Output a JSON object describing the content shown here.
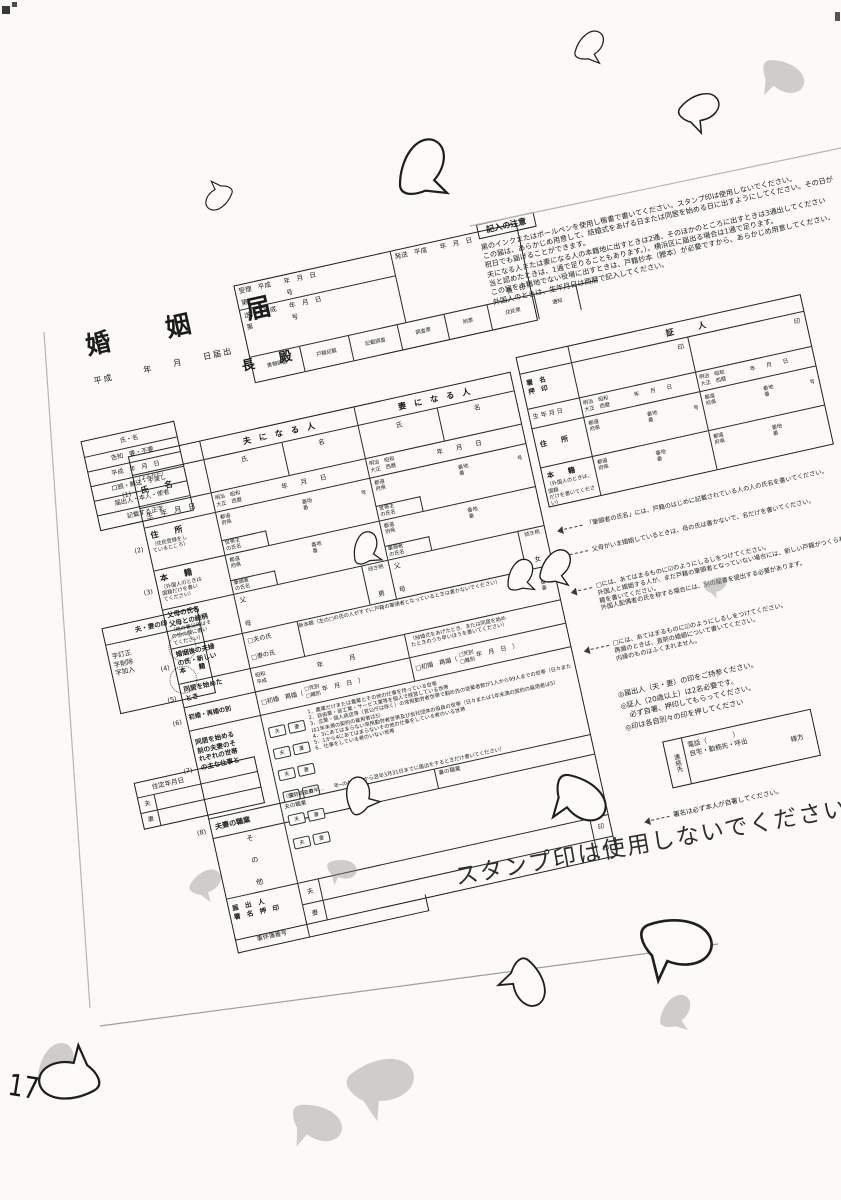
{
  "title_block": {
    "title": "婚　姻　届",
    "date_line": "平成　　　年　　月　　日届出",
    "addressee": "長　殿"
  },
  "receipt_box": {
    "juri": "受理　平成　　年　月　日",
    "juri_no": "第　　　　　　号",
    "hasso": "発送　平成　　年　月　日",
    "mayor_seal": "長　印",
    "sofu": "送付　平成　　年　月　日",
    "sofu_no": "第　　　　　　号",
    "cells": [
      "書類調査",
      "戸籍記載",
      "記載調査",
      "調査票",
      "附票",
      "住民票",
      "通知"
    ]
  },
  "notes_top": {
    "heading": "記入の注意",
    "lines": [
      "黒のインクまたはボールペンを使用し楷書で書いてください。スタンプ印は使用しないでください。",
      "この届は、あらかじめ用意して、結婚式をあげる日または同居を始める日に出すようにしてください。その日が",
      "祝日でも届けることができます。",
      "夫になる人または妻になる人の本籍地に出すときは2通、そのほかのところに出すときは3通出してください",
      "当と認めたときは、1通で足りることもあります。）。横浜区に届出る場合は1通で足ります。",
      "この届を本籍地でない役場に出すときは、戸籍抄本（謄本）が必要ですから、あらかじめ用意してください、",
      "外国人のときは、生年月日は西暦で記入してください。"
    ]
  },
  "admin_box": {
    "rows": [
      "氏・名",
      "告知　要・不要",
      "平成　年　月　日",
      "口頭・郵送・手渡し",
      "届出人・本人・使者",
      "記載する正字"
    ]
  },
  "seal_box": {
    "title": "夫・妻の印",
    "lines": "字訂正\n字削除\n字加入"
  },
  "jutei_box": {
    "title": "住定年月日",
    "husband": "夫",
    "wife": "妻"
  },
  "form": {
    "header": {
      "husband": "夫　に　な　る　人",
      "wife": "妻　に　な　る　人"
    },
    "name": {
      "num": "(1)",
      "kana": "（よみかた）",
      "label": "氏　　名",
      "last": "氏",
      "first": "名"
    },
    "birth": {
      "label": "生　年　月　日",
      "era": "明治　昭和\n大正　西暦",
      "ymd": "年　　月　　日"
    },
    "address": {
      "num": "(2)",
      "label": "住　　所",
      "sub": "（住民登録をし\nているところ）",
      "pref": "都道\n府県",
      "banchi": "番地\n番",
      "go": "号",
      "householder": "世帯主\nの氏名"
    },
    "honseki": {
      "num": "(3)",
      "label": "本　　籍",
      "sub": "（外国人のときは\n国籍だけを書い\nてください）",
      "pref": "都道\n府県",
      "banchi": "番地\n番",
      "head": "筆頭者\nの氏名"
    },
    "parents": {
      "label": "父母の氏名\n父母との続柄",
      "sub": "（他の養父母はそ\nの他の欄に書い\nてください）",
      "father": "父",
      "mother": "母",
      "relation": "続き柄",
      "son": "男",
      "daughter": "女"
    },
    "after_marriage": {
      "num": "(4)",
      "label": "婚姻後の夫婦\nの氏・新しい\n本　　籍",
      "husband_opt": "□夫の氏",
      "wife_opt": "□妻の氏",
      "new_honseki": "新本籍（左の□の氏の人がすでに戸籍の筆頭者となっているときは書かないでください）",
      "banchi": "番地\n番"
    },
    "cohabit": {
      "num": "(5)",
      "label": "同居を始めた\nとき",
      "era": "昭和\n平成",
      "ym": "年　　　　月",
      "note": "（結婚式をあげたとき、または同居を始め\nたときのうち早いほうを書いてください）"
    },
    "marriage_history": {
      "num": "(6)",
      "label": "初婚・再婚の別",
      "opt": "□初婚　再婚（",
      "death": "□死別",
      "divorce": "□離別",
      "ymd": "年　月　日　）"
    },
    "household_work": {
      "num": "(7)",
      "label": "同居を始める\n前の夫妻のそ\nれぞれの世帯\nの主な仕事と",
      "husband": "夫",
      "wife": "妻",
      "items": [
        "1．農業だけまたは農業とその他の仕事を持っている世帯",
        "2．自由業・商工業・サービス業等を個人で経営している世帯",
        "3．企業・個人商店等（官公庁は除く）の常用勤労者世帯で勤め先の従業者数が1人から99人までの世帯（日々または1年未満の契約の雇用者は5）",
        "4．3にあてはまらない常用勤労者世帯及び会社団体の役員の世帯（日々または1年未満の契約の雇用者は5）",
        "5．1から4にあてはまらないその他の仕事をしている者のいる世帯",
        "6．仕事をしている者のいない世帯"
      ],
      "note": "（国勢調査の年…　　年─の4月1日から翌年3月31日までに届出をするときだけ書いてください）"
    },
    "occupation": {
      "num": "(8)",
      "label": "夫妻の職業",
      "husband": "夫の職業",
      "wife": "妻の職業"
    },
    "other": {
      "label": "そ　の　他"
    },
    "declarant": {
      "label": "届　出　人\n署　名　押　印",
      "husband": "夫",
      "wife": "妻",
      "seal": "印"
    },
    "case_number": {
      "label": "事件簿番号"
    }
  },
  "witness": {
    "header": "証　　　人",
    "sign_label": "署　名\n押　印",
    "seal": "印",
    "birth_label": "生 年 月 日",
    "era": "明治　昭和\n大正　西暦",
    "ymd": "年　　月　　日",
    "address_label": "住　　所",
    "pref": "都道\n府県",
    "banchi": "番地\n番",
    "go": "号",
    "honseki_label": "本　　籍",
    "honseki_note": "（外国人のときは、国籍\nだけを書いてください）"
  },
  "side_notes": {
    "head_of_family": "「筆頭者の氏名」には、戸籍のはじめに記載されている人の人の氏名を書いてください。",
    "parents_married": "父母がいま婚姻しているときは、母の氏は書かないで、名だけを書いてください。",
    "checkbox_new_honseki": "□には、あてはまるものに☑のようにしるしをつけてください。\n外国人と婚姻する人が、まだ戸籍の筆頭者となっていない場合には、新しい戸籍がつくられますので、希望する本籍を書いてください。\n外国人配偶者の氏を称する場合には、別の届書を提出する必要があります。",
    "checkbox_remarriage": "□には、あてはまるものに☑のようにしるしをつけてください。\n再婚のときは、直前の婚姻について書いてください。\n内縁のものはふくまれません。",
    "bring_seal": "◎届出人（夫・妻）の印をご持参ください。",
    "witness_required": "◎証人（20歳以上）は2名必要です。",
    "witness_sign": "　必ず自署、押印してもらってください。",
    "separate_seals": "◎印は各自別々の印を押してください",
    "signature": "署名は必ず本人が自署してください。"
  },
  "contact_box": {
    "label": "連絡先",
    "phone": "電話（　　　　）",
    "line2": "自宅・勤務先・呼出",
    "line3": "様方"
  },
  "stamp_warning": "スタンプ印は使用しないでください",
  "margin_marks": "17"
}
